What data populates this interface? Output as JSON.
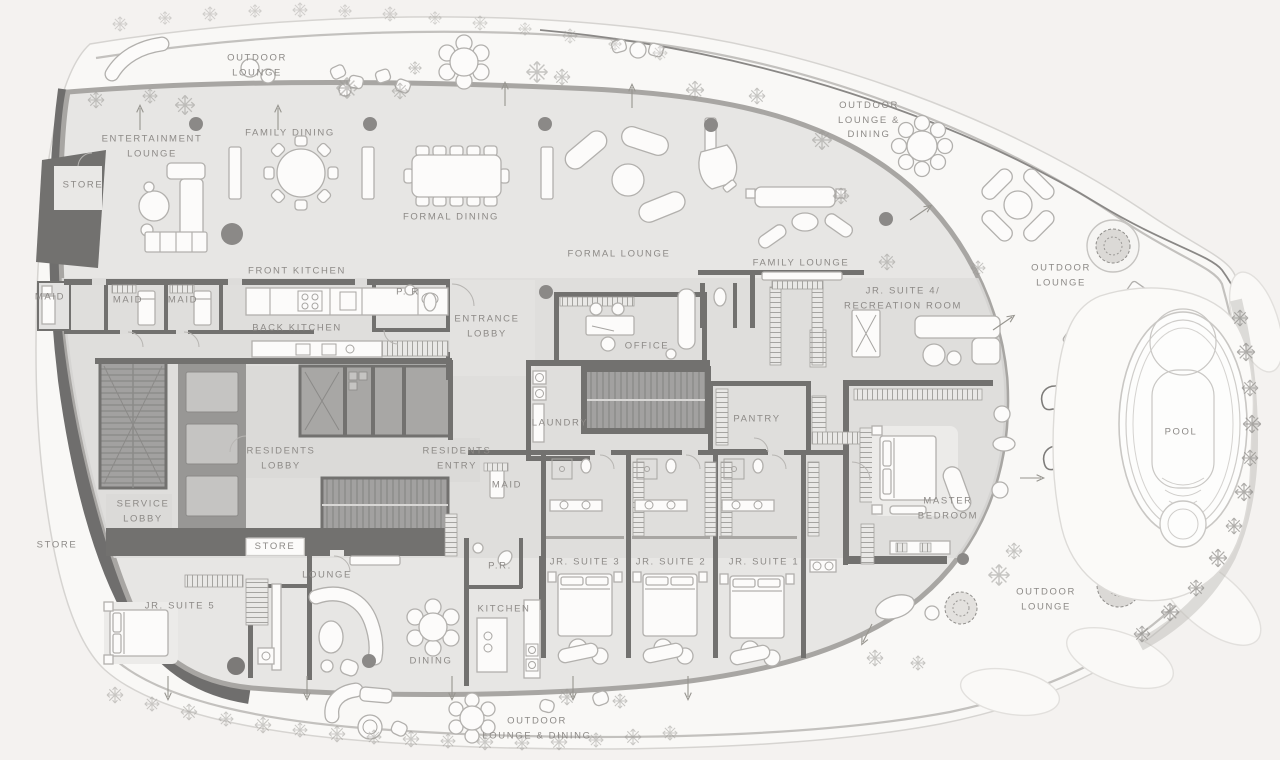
{
  "plan": {
    "type": "penthouse-floor-plan",
    "palette": {
      "page_background": "#f4f2f0",
      "terrace": "#f9f8f6",
      "outer_line": "#d6d4d1",
      "parapet_line": "#bdbbb8",
      "floor": "#e7e6e4",
      "central_band": "#dddcda",
      "wall": "#72716f",
      "core_fill": "#a8a7a5",
      "stair_fill": "#9e9d9b",
      "corridor": "#dbdad8",
      "furniture_fill": "#fcfbfa",
      "furniture_stroke": "#b2b0ad",
      "label_text": "#8d8a87",
      "column_dot": "#8b8987"
    },
    "labels": [
      {
        "id": "outdoor-lounge-top",
        "text": "OUTDOOR\nLOUNGE",
        "x": 257,
        "y": 66
      },
      {
        "id": "family-dining",
        "text": "FAMILY DINING",
        "x": 290,
        "y": 134
      },
      {
        "id": "entertainment-lounge",
        "text": "ENTERTAINMENT\nLOUNGE",
        "x": 152,
        "y": 147
      },
      {
        "id": "store-upper-left",
        "text": "STORE",
        "x": 83,
        "y": 186
      },
      {
        "id": "formal-dining",
        "text": "FORMAL DINING",
        "x": 451,
        "y": 218
      },
      {
        "id": "front-kitchen",
        "text": "FRONT KITCHEN",
        "x": 297,
        "y": 272
      },
      {
        "id": "formal-lounge",
        "text": "FORMAL LOUNGE",
        "x": 619,
        "y": 255
      },
      {
        "id": "family-lounge",
        "text": "FAMILY LOUNGE",
        "x": 801,
        "y": 264
      },
      {
        "id": "outdoor-lounge-dining-top",
        "text": "OUTDOOR\nLOUNGE &\nDINING",
        "x": 869,
        "y": 121
      },
      {
        "id": "jr-suite-4-recreation",
        "text": "JR. SUITE 4/\nRECREATION ROOM",
        "x": 903,
        "y": 299
      },
      {
        "id": "outdoor-lounge-right",
        "text": "OUTDOOR\nLOUNGE",
        "x": 1061,
        "y": 276
      },
      {
        "id": "maid-1",
        "text": "MAID",
        "x": 50,
        "y": 298
      },
      {
        "id": "maid-2",
        "text": "MAID",
        "x": 128,
        "y": 301
      },
      {
        "id": "maid-3",
        "text": "MAID",
        "x": 183,
        "y": 301
      },
      {
        "id": "back-kitchen",
        "text": "BACK KITCHEN",
        "x": 297,
        "y": 329
      },
      {
        "id": "pr-upper",
        "text": "P. R",
        "x": 408,
        "y": 293
      },
      {
        "id": "entrance-lobby",
        "text": "ENTRANCE\nLOBBY",
        "x": 487,
        "y": 327
      },
      {
        "id": "office",
        "text": "OFFICE",
        "x": 647,
        "y": 347
      },
      {
        "id": "laundry",
        "text": "LAUNDRY",
        "x": 560,
        "y": 424
      },
      {
        "id": "pantry",
        "text": "PANTRY",
        "x": 757,
        "y": 420
      },
      {
        "id": "residents-lobby",
        "text": "RESIDENTS\nLOBBY",
        "x": 281,
        "y": 459
      },
      {
        "id": "residents-entry",
        "text": "RESIDENTS\nENTRY",
        "x": 457,
        "y": 459
      },
      {
        "id": "maid-4",
        "text": "MAID",
        "x": 507,
        "y": 486
      },
      {
        "id": "service-lobby",
        "text": "SERVICE\nLOBBY",
        "x": 143,
        "y": 512
      },
      {
        "id": "store-lower-left",
        "text": "STORE",
        "x": 57,
        "y": 546
      },
      {
        "id": "store-central",
        "text": "STORE",
        "x": 275,
        "y": 547,
        "plate": true
      },
      {
        "id": "lounge",
        "text": "LOUNGE",
        "x": 327,
        "y": 576
      },
      {
        "id": "jr-suite-5",
        "text": "JR. SUITE 5",
        "x": 180,
        "y": 607
      },
      {
        "id": "pr-lower",
        "text": "P.R.",
        "x": 500,
        "y": 567
      },
      {
        "id": "kitchen",
        "text": "KITCHEN",
        "x": 504,
        "y": 610
      },
      {
        "id": "jr-suite-3",
        "text": "JR. SUITE 3",
        "x": 585,
        "y": 563
      },
      {
        "id": "jr-suite-2",
        "text": "JR. SUITE 2",
        "x": 671,
        "y": 563
      },
      {
        "id": "jr-suite-1",
        "text": "JR. SUITE 1",
        "x": 764,
        "y": 563
      },
      {
        "id": "master-bedroom",
        "text": "MASTER\nBEDROOM",
        "x": 948,
        "y": 509
      },
      {
        "id": "dining",
        "text": "DINING",
        "x": 431,
        "y": 662
      },
      {
        "id": "outdoor-lounge-dining-bottom",
        "text": "OUTDOOR\nLOUNGE & DINING",
        "x": 537,
        "y": 729
      },
      {
        "id": "outdoor-lounge-bottom-right",
        "text": "OUTDOOR\nLOUNGE",
        "x": 1046,
        "y": 600
      },
      {
        "id": "pool",
        "text": "POOL",
        "x": 1181,
        "y": 433
      }
    ]
  }
}
